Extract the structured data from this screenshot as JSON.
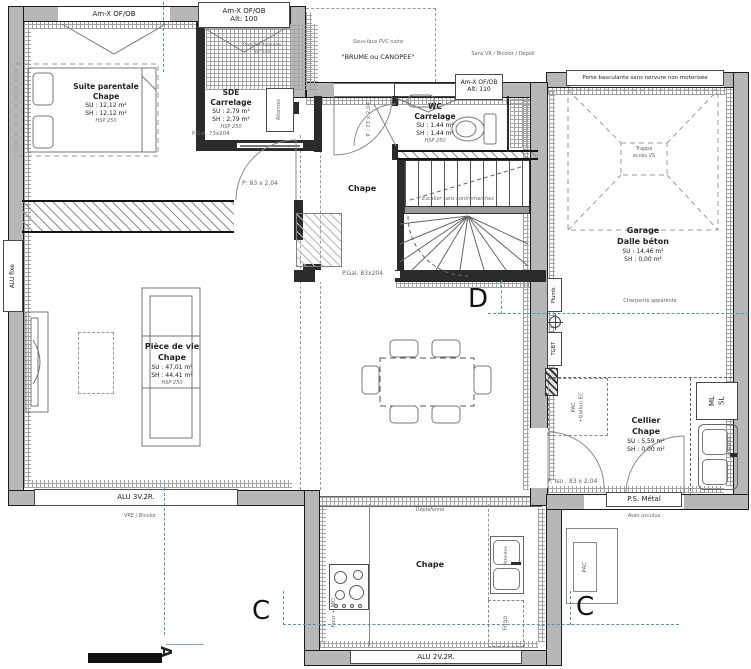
{
  "colors": {
    "wall": "#b7b7b7",
    "line": "#1c1c1c",
    "section_blue": "#3f9ad2"
  },
  "rooms": {
    "suite": {
      "name": "Suite parentale",
      "finish": "Chape",
      "su": "SU : 12,12 m²",
      "sh": "SH : 12,12 m²",
      "hsp": "HSP 250"
    },
    "sde": {
      "name": "SDE",
      "finish": "Carrelage",
      "su": "SU : 2,79 m²",
      "sh": "SH : 2,79 m²",
      "hsp": "HSP 250"
    },
    "wc": {
      "name": "WC",
      "finish": "Carrelage",
      "su": "SU : 1,44 m²",
      "sh": "SH : 1,44 m²",
      "hsp": "HSP 250"
    },
    "hall": {
      "finish": "Chape"
    },
    "garage": {
      "name": "Garage",
      "finish": "Dalle béton",
      "su": "SU : 14,46 m²",
      "sh": "SH : 0,00 m²"
    },
    "living": {
      "name": "Pièce de vie",
      "finish": "Chape",
      "su": "SU : 47,01 m²",
      "sh": "SH : 44,41 m²",
      "hsp": "HSP 250"
    },
    "cellier": {
      "name": "Cellier",
      "finish": "Chape",
      "su": "SU : 5,59 m²",
      "sh": "SH : 0,00 m²"
    },
    "kitchen": {
      "finish": "Chape",
      "ceiling": "Déplafonné"
    }
  },
  "openings": {
    "win_suite": "Am-X OF/OB",
    "win_sde": "Am-X OF/OB",
    "win_sde_alt": "Alt: 100",
    "win_wc": "Am-X OF/OB",
    "win_wc_alt": "Alt: 110",
    "garage_door": "Porte basculante sans nervure non motorisée",
    "win_left": "ALU fixe",
    "win_living": "ALU 3V.2R.",
    "win_kitchen": "ALU 2V.2R.",
    "door_ps": "P.S. Métal",
    "door_iso": "P. Iso : 83 x 2,04",
    "door_suite": "P: 83 x 2,04",
    "door_sde": "P.Gal. 73x204",
    "door_hall": "P.Gal. 83x204",
    "door_wc": "P : 73 x 2,04"
  },
  "notes": {
    "sans_vr": "Sans VR / Bicolor / Dépoli",
    "sous_face": "Sous-face PVC noire",
    "brume": "\"BRUME ou CANOPEE\"",
    "vre": "VRE / Bicolor",
    "occulus": "Avec occulus",
    "charpente": "Charpente apparente",
    "stairs": "Escalier sans contremarches",
    "shower_l1": "Douche italienne",
    "shower_l2": "90*140",
    "trappe_l1": "Trappe",
    "trappe_l2": "accès VS"
  },
  "equipment": {
    "plumb": "Plumb.",
    "tgbt": "TGBT",
    "pac_l1": "PAC",
    "pac_l2": "+ballon EC",
    "ml": "ML",
    "sl": "SL",
    "attentes": "Attentes",
    "four": "Four + MO",
    "frigo": "Frigo",
    "pac_ext": "PAC"
  },
  "markers": {
    "a": "A",
    "c": "C",
    "d": "D"
  }
}
